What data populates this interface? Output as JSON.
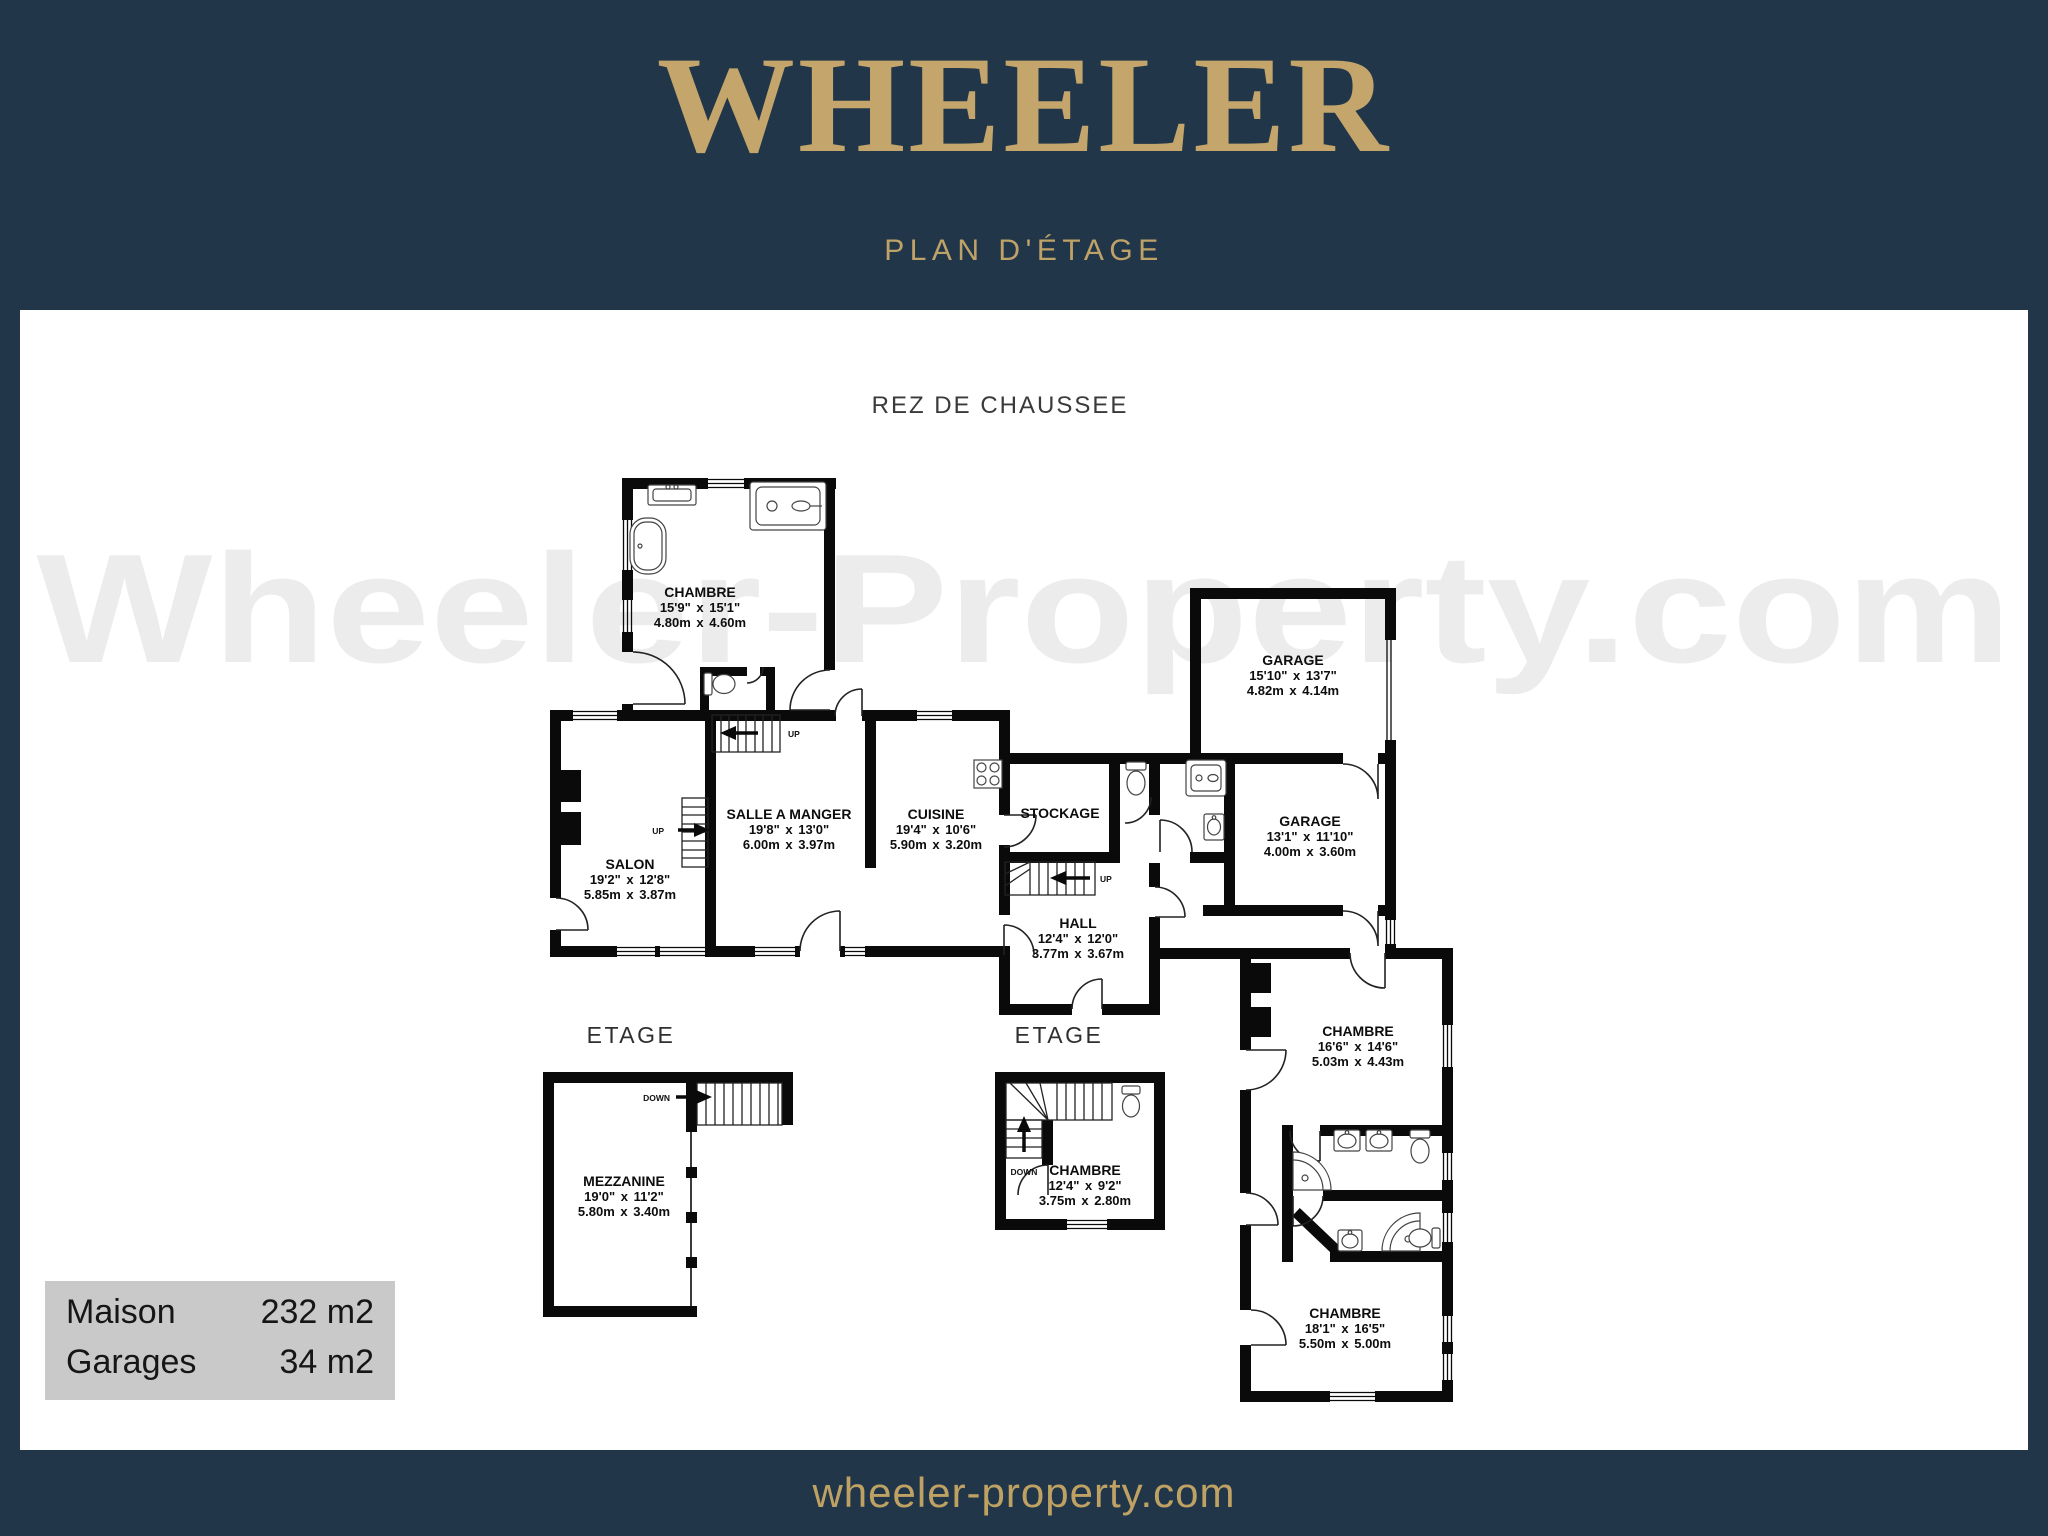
{
  "header": {
    "brand": "WHEELER",
    "subtitle": "PLAN D'ÉTAGE"
  },
  "plan": {
    "ground_floor_label": "REZ DE CHAUSSEE",
    "upper_floor_label_left": "ETAGE",
    "upper_floor_label_mid": "ETAGE",
    "watermark": "Wheeler-Property.com",
    "rooms": {
      "chambre_tl": {
        "name": "CHAMBRE",
        "imperial": "15'9\" x 15'1\"",
        "metric": "4.80m x 4.60m"
      },
      "salon": {
        "name": "SALON",
        "imperial": "19'2\" x 12'8\"",
        "metric": "5.85m x 3.87m"
      },
      "salle_a_manger": {
        "name": "SALLE A MANGER",
        "imperial": "19'8\" x 13'0\"",
        "metric": "6.00m x 3.97m"
      },
      "cuisine": {
        "name": "CUISINE",
        "imperial": "19'4\" x 10'6\"",
        "metric": "5.90m x 3.20m"
      },
      "stockage": {
        "name": "STOCKAGE"
      },
      "hall": {
        "name": "HALL",
        "imperial": "12'4\" x 12'0\"",
        "metric": "3.77m x 3.67m"
      },
      "garage_top": {
        "name": "GARAGE",
        "imperial": "15'10\" x 13'7\"",
        "metric": "4.82m x 4.14m"
      },
      "garage_right": {
        "name": "GARAGE",
        "imperial": "13'1\" x 11'10\"",
        "metric": "4.00m x 3.60m"
      },
      "chambre_right": {
        "name": "CHAMBRE",
        "imperial": "16'6\" x 14'6\"",
        "metric": "5.03m x 4.43m"
      },
      "chambre_bottom_right": {
        "name": "CHAMBRE",
        "imperial": "18'1\" x 16'5\"",
        "metric": "5.50m x 5.00m"
      },
      "mezzanine": {
        "name": "MEZZANINE",
        "imperial": "19'0\" x 11'2\"",
        "metric": "5.80m x 3.40m"
      },
      "chambre_etage": {
        "name": "CHAMBRE",
        "imperial": "12'4\" x 9'2\"",
        "metric": "3.75m x 2.80m"
      }
    },
    "stair_labels": {
      "up": "UP",
      "down": "DOWN"
    }
  },
  "summary": {
    "rows": [
      {
        "label": "Maison",
        "value": "232 m2"
      },
      {
        "label": "Garages",
        "value": "34 m2"
      }
    ]
  },
  "footer": {
    "website": "wheeler-property.com"
  },
  "colors": {
    "navy": "#213749",
    "gold": "#c4a56c",
    "summary_bg": "#c9c9c9",
    "plan_line": "#0a0a0a",
    "watermark_gray": "#ececec"
  }
}
